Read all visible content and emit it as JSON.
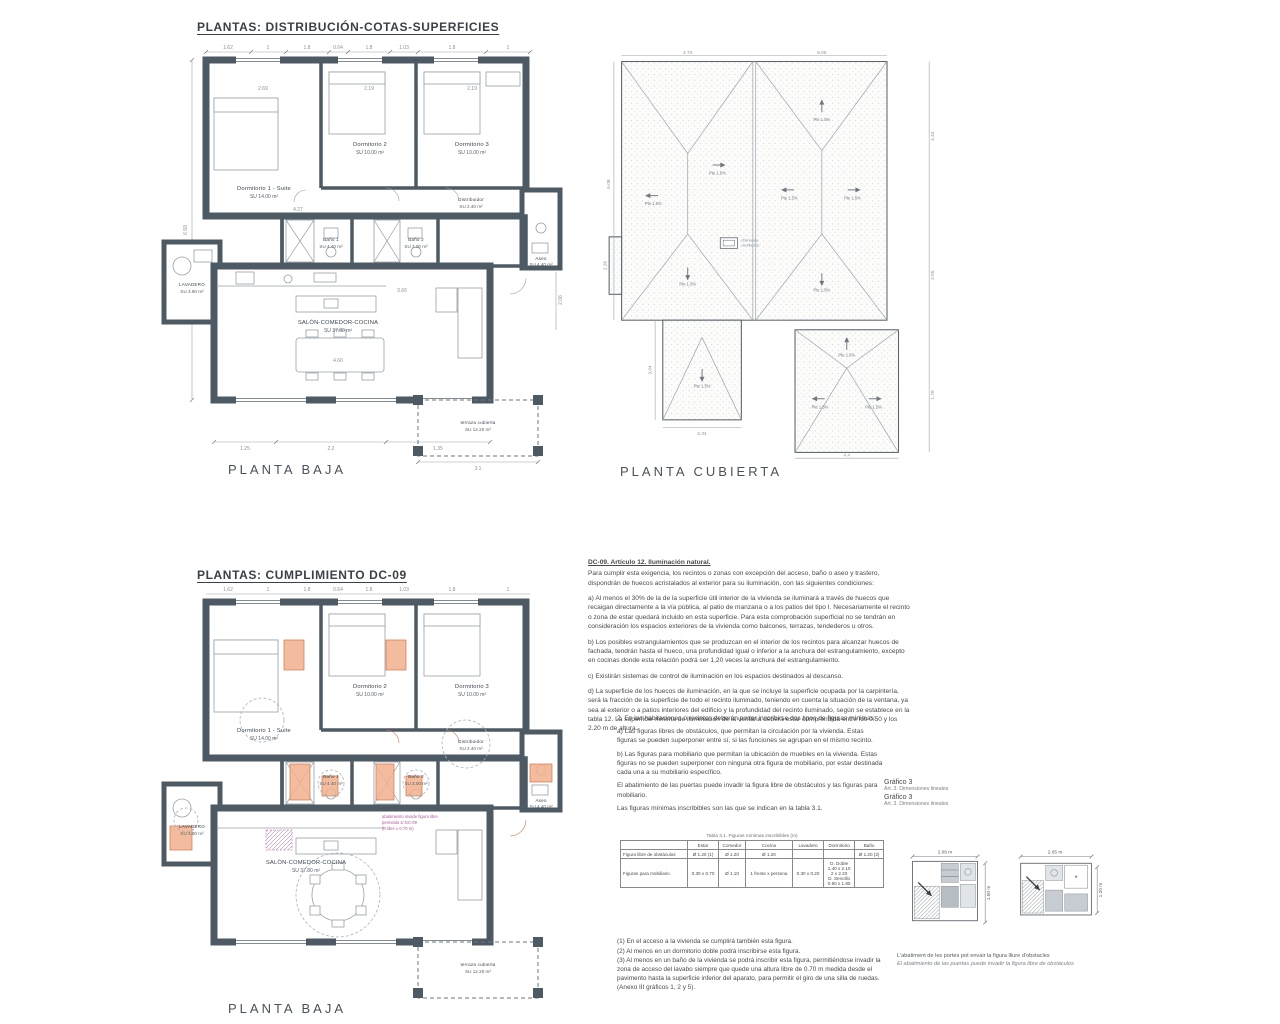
{
  "titles": {
    "section1": "PLANTAS: DISTRIBUCIÓN-COTAS-SUPERFICIES",
    "section2": "PLANTAS: CUMPLIMIENTO DC-09"
  },
  "captions": {
    "planta_baja": "PLANTA BAJA",
    "planta_cubierta": "PLANTA CUBIERTA"
  },
  "rooms": {
    "dorm1": "Dormitorio 1 - Suite",
    "dorm1_area": "SU 14.00 m²",
    "dorm2": "Dormitorio 2",
    "dorm2_area": "SU 10.00 m²",
    "dorm3": "Dormitorio 3",
    "dorm3_area": "SU 10.00 m²",
    "distribuidor": "Distribuidor",
    "distribuidor_area": "SU 2.40 m²",
    "bano1": "Baño 1",
    "bano1_area": "SU 4.40 m²",
    "bano2": "Baño 2",
    "bano2_area": "SU 3.00 m²",
    "aseo": "Aseo",
    "aseo_area": "SU 4.40 m²",
    "lavadero": "LAVADERO",
    "lavadero_area": "SU 3.80 m²",
    "salon": "SALÓN-COMEDOR-COCINA",
    "salon_area": "SU 37.80 m²",
    "terraza": "terraza cubierta",
    "terraza_area": "SU 12.20 m²"
  },
  "plan_dims": {
    "top": [
      "1.62",
      "1",
      "1.8",
      "0.64",
      "1.8",
      "1.03",
      "1.8",
      "1"
    ],
    "left": "6.59",
    "right": "2.06",
    "inner": [
      "2.69",
      "2.19",
      "2.19",
      "4.27",
      "3.66",
      "4.60"
    ],
    "bottom": [
      "1.25",
      "2.2",
      "1.35"
    ],
    "terraza": "3.1"
  },
  "annotations": {
    "line1": "abatimiento invade figura libre",
    "line2": "permitido s/ DC-09",
    "line3": "(h libre ≥ 0.70 m)"
  },
  "roof": {
    "slope": "Pte 1.5%",
    "legend1": "chimenea",
    "legend2": "ventilación",
    "dims": {
      "top1": "4.74",
      "top2": "6.05",
      "left1": "6.08",
      "left2": "2.26",
      "left3": "3.04",
      "right1": "4.44",
      "right2": "2.55",
      "right3": "1.78",
      "bottom1": "5.34",
      "bottom2": "4.4"
    }
  },
  "dc09": {
    "heading": "DC-09. Artículo 12. Iluminación natural.",
    "intro": "Para cumplir esta exigencia, los recintos o zonas con excepción del acceso, baño o aseo y trastero, dispondrán de huecos acristalados al exterior para su iluminación, con las siguientes condiciones:",
    "a": "a) Al menos el 30% de la de la superficie útil interior de la vivienda se iluminará a través de huecos que recaigan directamente a la vía pública, al patio de manzana o a los patios del tipo I. Necesariamente el recinto o zona de estar quedará incluido en esta superficie. Para esta comprobación superficial no se tendrán en consideración los espacios exteriores de la vivienda como balcones, terrazas, tendederos u otros.",
    "b": "b) Los posibles estrangulamientos que se produzcan en el interior de los recintos para alcanzar huecos de fachada, tendrán hasta el hueco, una profundidad igual o inferior a la anchura del estrangulamiento, excepto en cocinas donde esta relación podrá ser 1,20 veces la anchura del estrangulamiento.",
    "c": "c) Existirán sistemas de control de iluminación en los espacios destinados al descanso.",
    "d": "d) La superficie de los huecos de iluminación, en la que se incluye la superficie ocupada por la carpintería, será la fracción de la superficie de todo el recinto iluminado, teniendo en cuenta la situación de la ventana, ya sea al exterior o a patios interiores del edificio y la profundidad del recinto iluminado, según se establece en la tabla 12. La superficie mínima de iluminación de la ventana deberá estar comprendida entre los 0.50 y los 2.20 m de altura."
  },
  "figuras": {
    "p0": "2. En las habitaciones o recintos deberán poder inscribirse dos tipos de figuras mínimas:",
    "pa": "a) Las figuras libres de obstáculos, que permitan la circulación por la vivienda. Estas figuras se pueden superponer entre sí, si las funciones se agrupan en el mismo recinto.",
    "pb": "b) Las figuras para mobiliario que permitan la ubicación de muebles en la vivienda. Estas figuras no se pueden superponer con ninguna otra figura de mobiliario, por estar destinada cada una a su mobiliario específico.",
    "pc": "El abatimiento de las puertas puede invadir la figura libre de obstáculos y las figuras para mobiliario.",
    "pd": "Las figuras mínimas inscribibles son las que se indican en la tabla 3.1."
  },
  "grafico": {
    "l1": "Gráfico 3",
    "s1": "Art. 3. Dimensiones lineales",
    "l2": "Gráfico 3",
    "s2": "Art. 3. Dimensiones lineales"
  },
  "tabla": {
    "title": "Tabla 3.1. Figuras mínimas inscribibles (m)",
    "headers": [
      "",
      "Estar",
      "Comedor",
      "Cocina",
      "Lavadero",
      "Dormitorio",
      "Baño"
    ],
    "rows": [
      {
        "label": "Figura libre de obstáculos",
        "c1": "Ø 1.20 (1)",
        "c2": "Ø 1.20",
        "c3": "Ø 1.20",
        "c4": "",
        "c5": "",
        "c6": "Ø 1.20 (2)"
      },
      {
        "label": "Figuras para mobiliario",
        "c1": "0.30 x 0.70",
        "c2": "Ø 1.10",
        "c3": "1 frente x persona",
        "c4": "0.30 x 0.20",
        "c5": "D. Doble\n1.40 x 2.10\n2 x 2.20\nD. Sencillo\n0.90 x 1.80",
        "c6": ""
      }
    ]
  },
  "notas": {
    "n1": "(1) En el acceso a la vivienda se cumplirá también esta figura.",
    "n2": "(2) Al menos en un dormitorio doble podrá inscribirse esta figura.",
    "n3": "(3) Al menos en un baño de la vivienda se podrá inscribir esta figura, permitiéndose invadir la zona de acceso del lavabo siempre que quede una altura libre de 0.70 m medida desde el pavimento hasta la superficie inferior del aparato, para permitir el giro de una silla de ruedas.",
    "n4": "(Anexo III gráficos 1, 2 y 5)."
  },
  "diagrams": {
    "d1_w": "2.06 m",
    "d1_h": "1.50 m",
    "d2_w": "2.65 m",
    "d2_h": "1.20 m",
    "cap1": "L'abatiment de les portes pot envair la figura lliure d'obstacles",
    "cap2": "El abatimiento de las puertas puede invadir la figura libre de obstáculos"
  }
}
